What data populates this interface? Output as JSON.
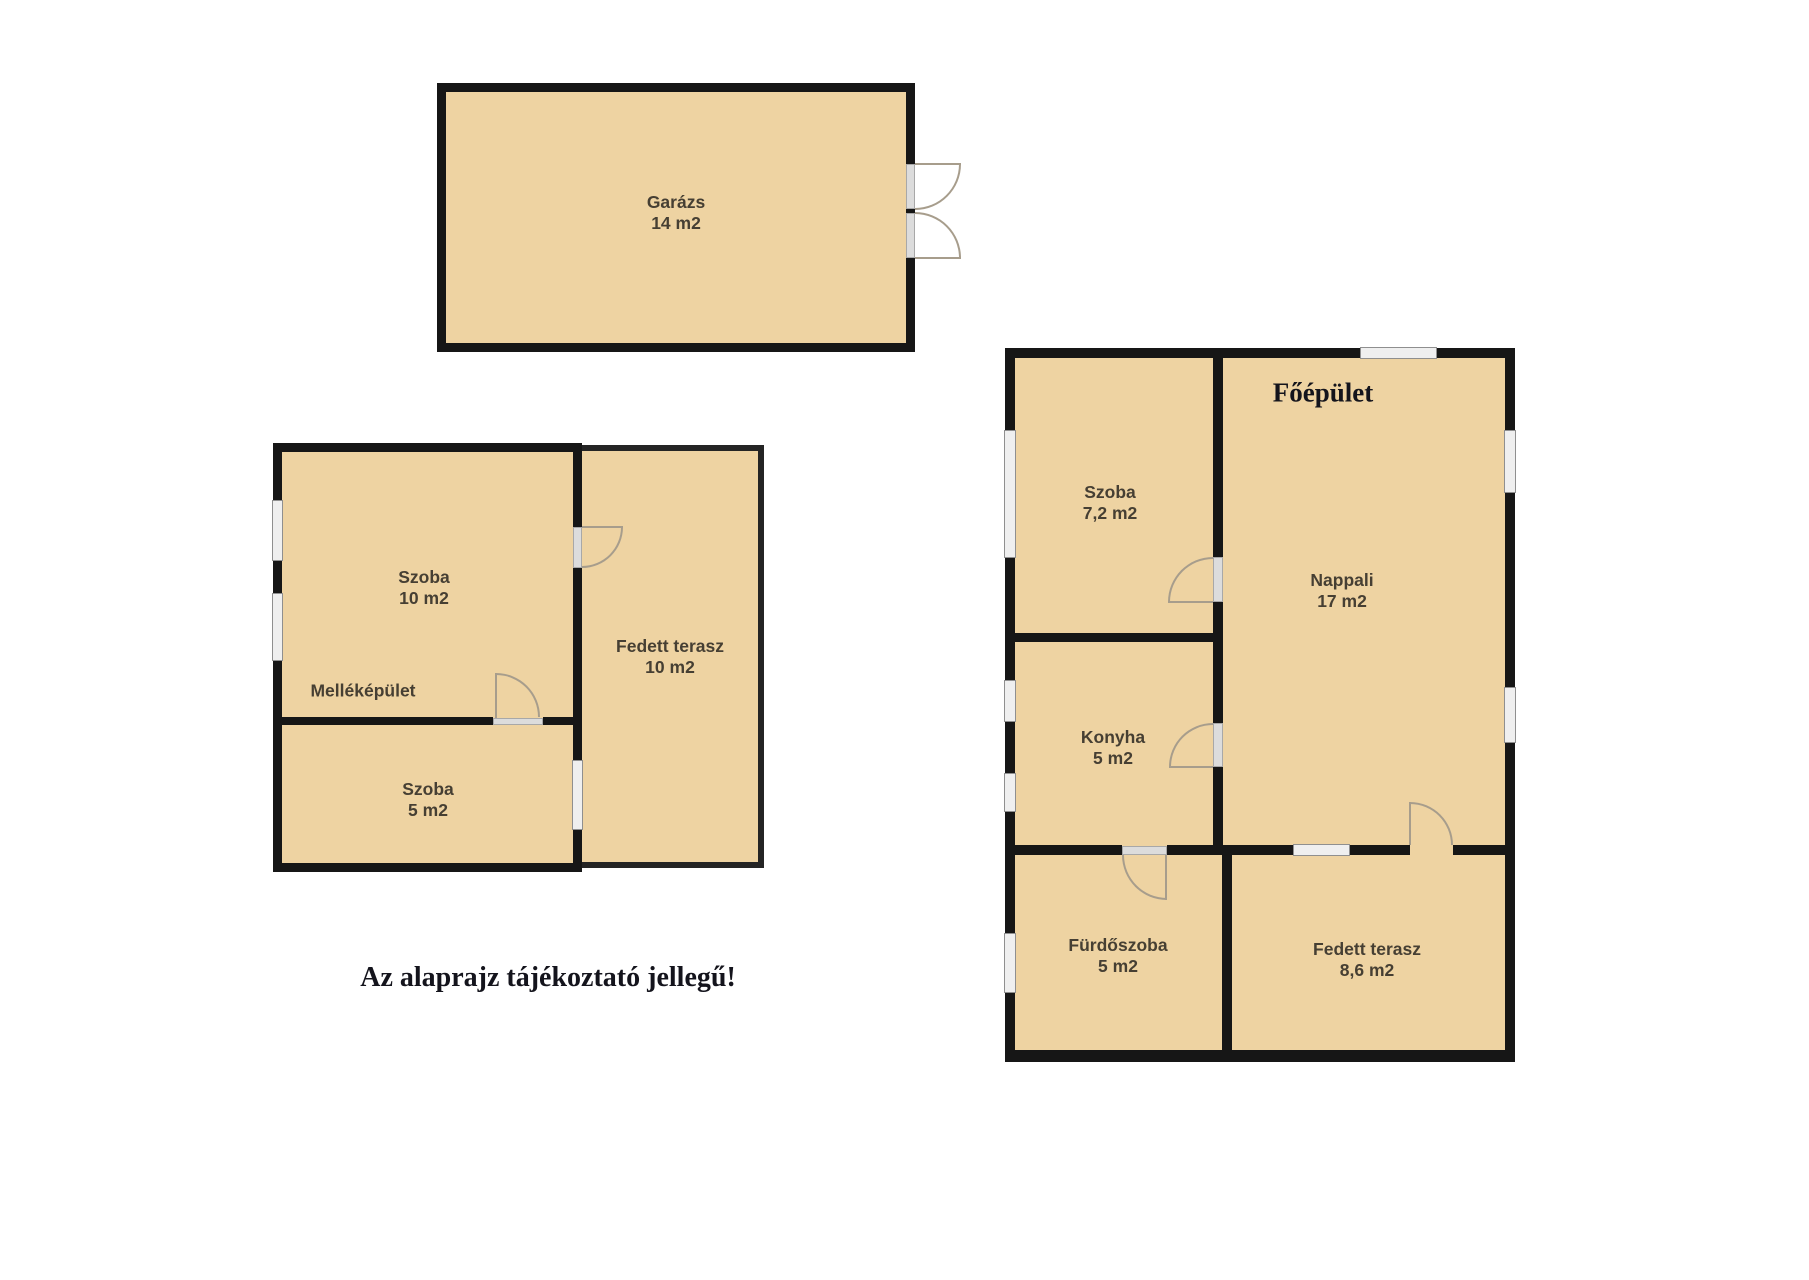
{
  "note": "Az alaprajz tájékoztató jellegű!",
  "garage": {
    "name": "Garázs",
    "area": "14 m2"
  },
  "outbuilding": {
    "label": "Melléképület",
    "szoba_nagy": {
      "name": "Szoba",
      "area": "10 m2"
    },
    "szoba_kis": {
      "name": "Szoba",
      "area": "5 m2"
    },
    "fedett_terasz": {
      "name": "Fedett terasz",
      "area": "10 m2"
    }
  },
  "main_building": {
    "label": "Főépület",
    "szoba": {
      "name": "Szoba",
      "area": "7,2 m2"
    },
    "nappali": {
      "name": "Nappali",
      "area": "17 m2"
    },
    "konyha": {
      "name": "Konyha",
      "area": "5 m2"
    },
    "furdoszoba": {
      "name": "Fürdőszoba",
      "area": "5 m2"
    },
    "fedett_terasz": {
      "name": "Fedett terasz",
      "area": "8,6 m2"
    }
  },
  "colors": {
    "room_fill": "#eed3a2",
    "wall": "#161616",
    "window_fill": "#efefef",
    "door_arc": "#a79d8c",
    "label_text": "#463f33",
    "title_text": "#14141c"
  }
}
